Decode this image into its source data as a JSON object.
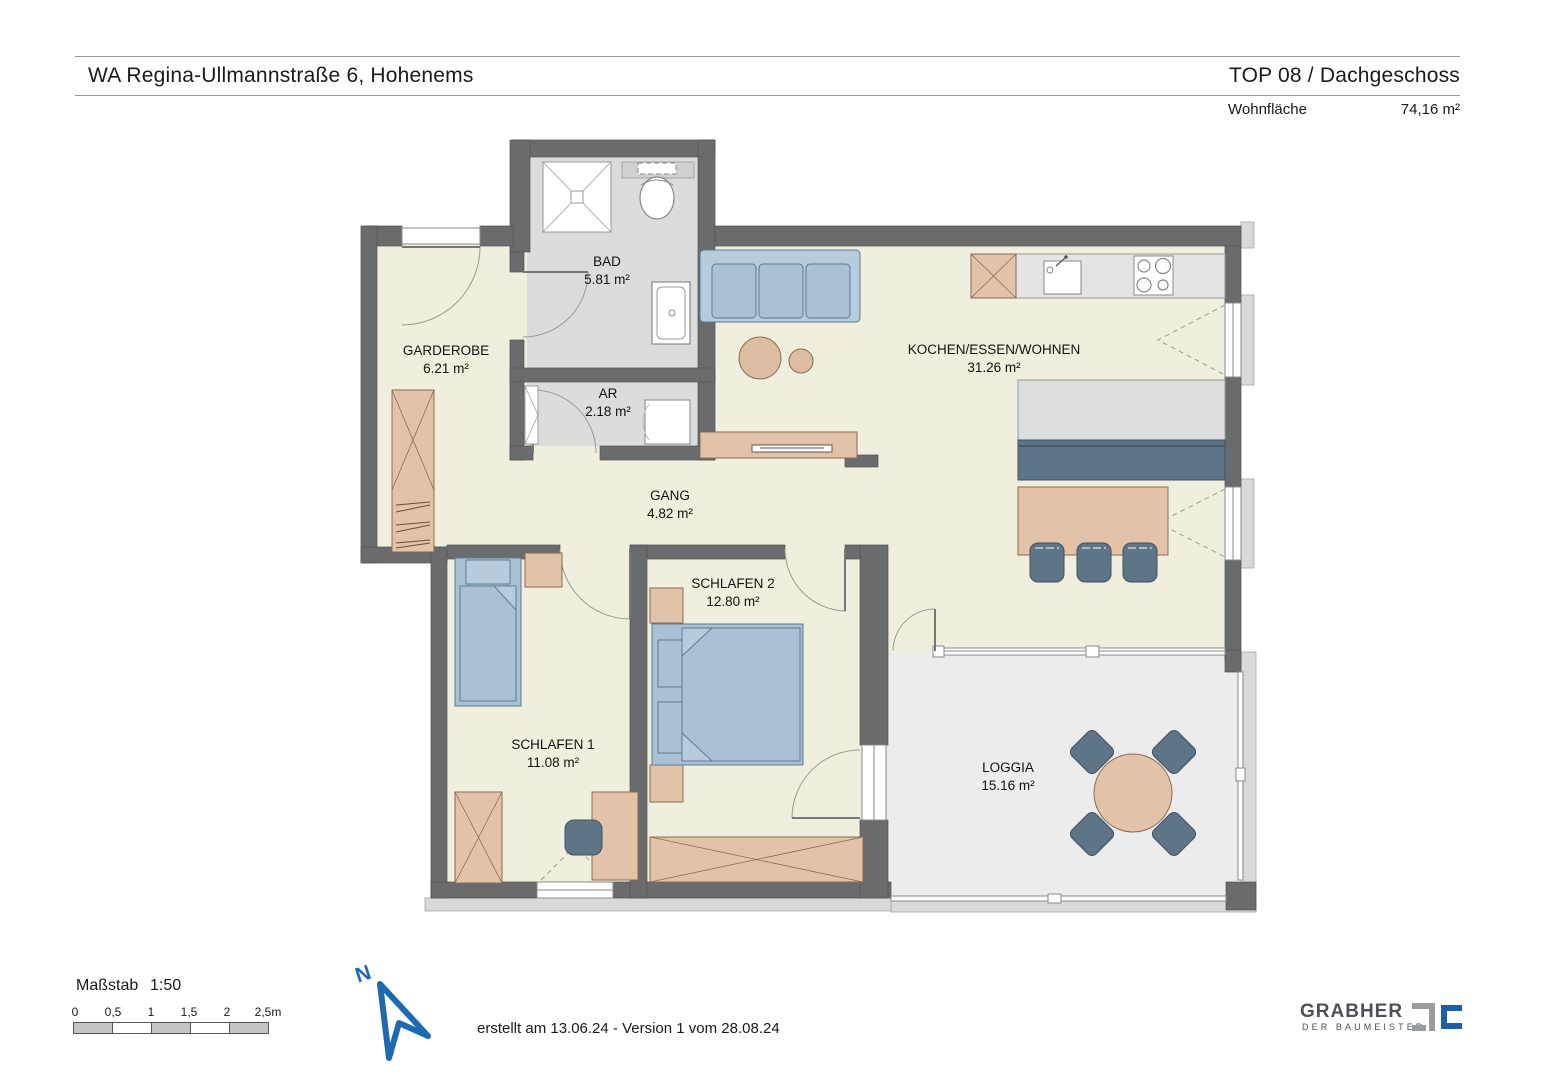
{
  "header": {
    "title": "WA Regina-Ullmannstraße 6, Hohenems",
    "unit": "TOP 08 / Dachgeschoss",
    "area_label": "Wohnfläche",
    "area_value": "74,16 m²"
  },
  "rooms": {
    "bad": {
      "name": "BAD",
      "area": "5.81 m²"
    },
    "garderobe": {
      "name": "GARDEROBE",
      "area": "6.21 m²"
    },
    "ar": {
      "name": "AR",
      "area": "2.18 m²"
    },
    "gang": {
      "name": "GANG",
      "area": "4.82 m²"
    },
    "wohnen": {
      "name": "KOCHEN/ESSEN/WOHNEN",
      "area": "31.26 m²"
    },
    "schlafen2": {
      "name": "SCHLAFEN 2",
      "area": "12.80 m²"
    },
    "schlafen1": {
      "name": "SCHLAFEN 1",
      "area": "11.08 m²"
    },
    "loggia": {
      "name": "LOGGIA",
      "area": "15.16 m²"
    }
  },
  "scale": {
    "label": "Maßstab",
    "ratio": "1:50",
    "ticks": [
      "0",
      "0,5",
      "1",
      "1,5",
      "2",
      "2,5m"
    ]
  },
  "north": {
    "label": "N"
  },
  "footer": {
    "created": "erstellt am 13.06.24 - Version 1 vom 28.08.24"
  },
  "logo": {
    "name": "GRABHER",
    "tagline": "DER BAUMEISTER"
  },
  "colors": {
    "wall": "#696b6d",
    "floor_living": "#f0efdd",
    "floor_wet": "#dcdcdd",
    "floor_loggia": "#ececec",
    "furniture_wood": "#e2c3a8",
    "furniture_blue": "#a9c1d3",
    "furniture_slate": "#5e7487",
    "north_blue": "#1e6ab0",
    "logo_blue": "#1e5fa8",
    "logo_gray": "#9a9d9f"
  }
}
